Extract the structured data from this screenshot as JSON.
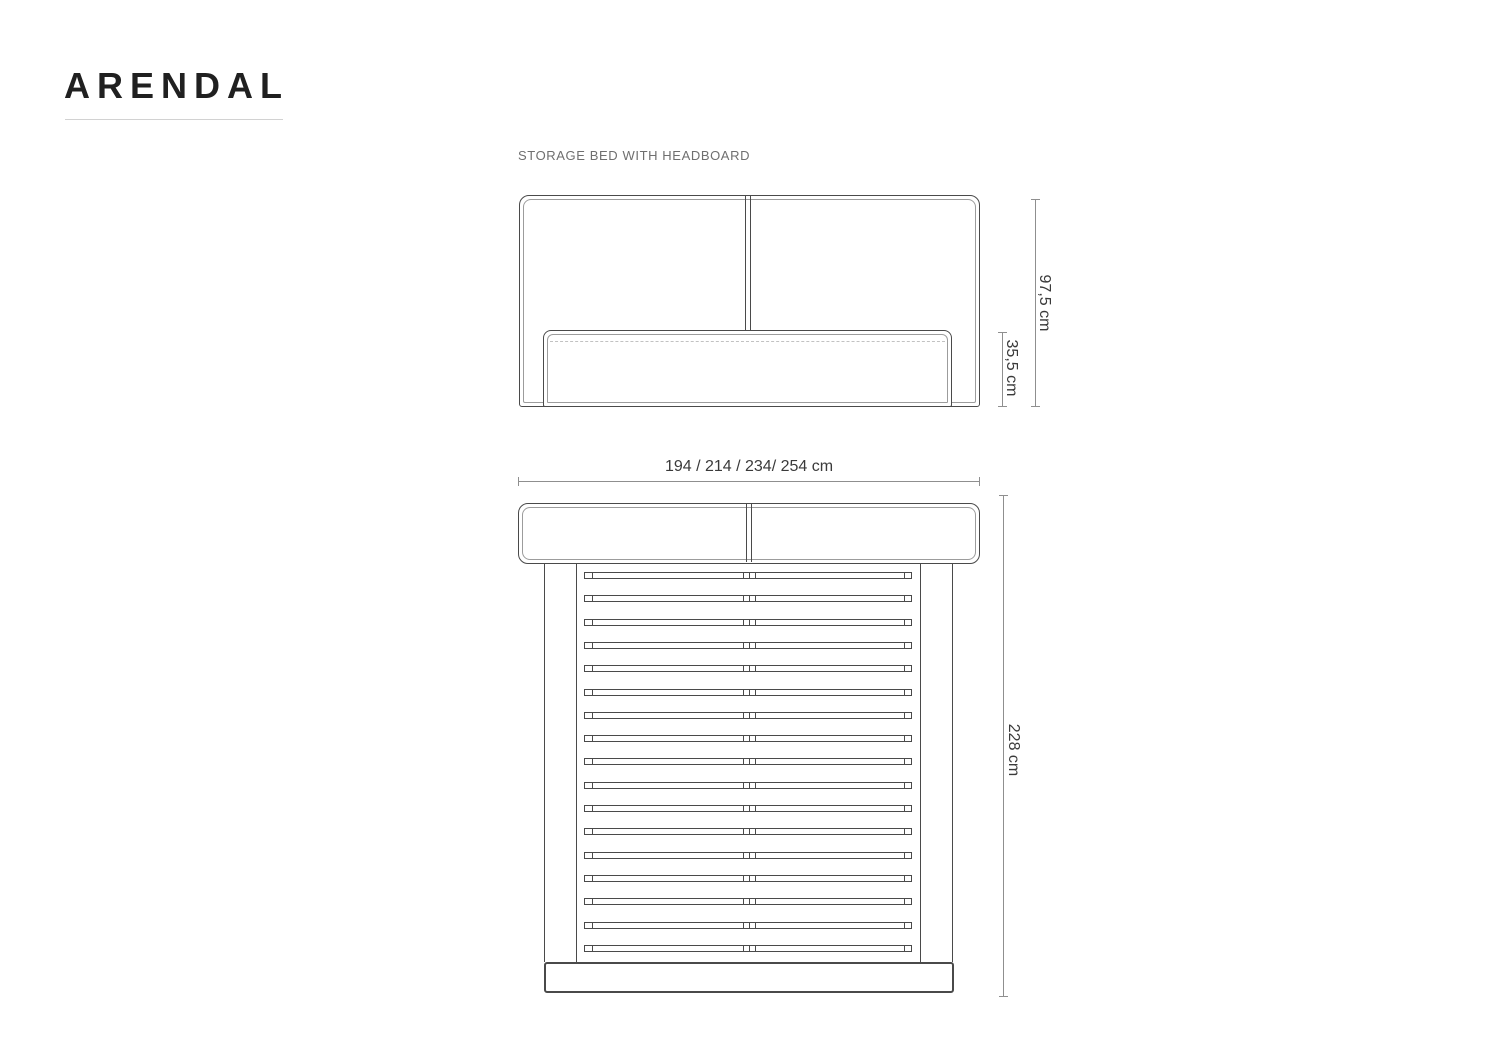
{
  "header": {
    "title": "ARENDAL",
    "subtitle": "STORAGE BED WITH HEADBOARD"
  },
  "front_view": {
    "name": "front elevation",
    "dim_total_height": "97,5 cm",
    "dim_frame_height": "35,5 cm"
  },
  "top_view": {
    "name": "top view",
    "dim_widths": "194 / 214 / 234/ 254 cm",
    "dim_length": "228 cm",
    "slat_count": 17
  },
  "colors": {
    "background": "#ffffff",
    "title_text": "#202020",
    "subtitle_text": "#6f6f6f",
    "drawing_outline": "#4a4a4a",
    "drawing_inner_line": "#9c9c9c",
    "stitch_line": "#c2c2c2",
    "dimension_line": "#8f8f8f",
    "dimension_text": "#3a3a3a",
    "title_underline": "#d2d2d2"
  }
}
